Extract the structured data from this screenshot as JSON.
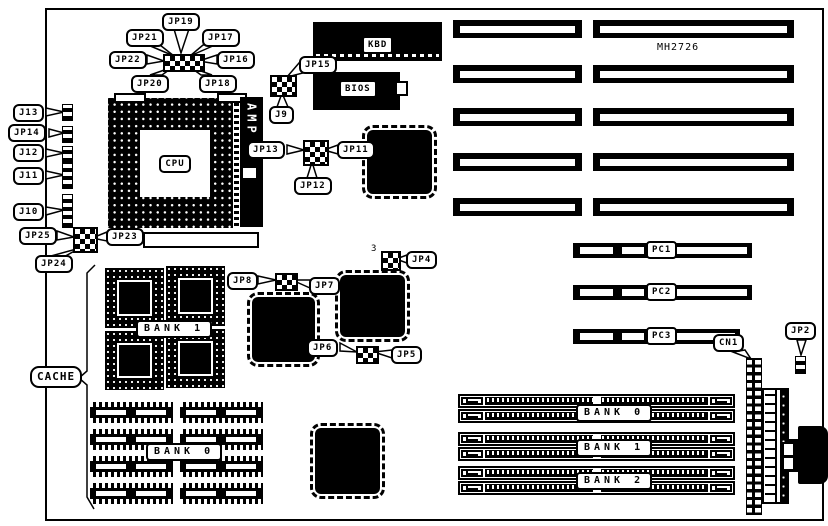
{
  "board": {
    "model": "MH2726"
  },
  "labels": {
    "jp19": "JP19",
    "jp21": "JP21",
    "jp17": "JP17",
    "jp22": "JP22",
    "jp16": "JP16",
    "jp20": "JP20",
    "jp18": "JP18",
    "jp15": "JP15",
    "j9": "J9",
    "kbd": "KBD",
    "bios": "BIOS",
    "j13": "J13",
    "jp14": "JP14",
    "j12": "J12",
    "j11": "J11",
    "j10": "J10",
    "jp25": "JP25",
    "jp23": "JP23",
    "jp24": "JP24",
    "cpu": "CPU",
    "amp": "AMP",
    "jp13": "JP13",
    "jp12": "JP12",
    "jp11": "JP11",
    "jp4": "JP4",
    "jp4_pin": "3",
    "jp8": "JP8",
    "jp7": "JP7",
    "jp6": "JP6",
    "jp5": "JP5",
    "cache": "CACHE",
    "cache_bank1": "BANK 1",
    "cache_bank0": "BANK 0",
    "pc1": "PC1",
    "pc2": "PC2",
    "pc3": "PC3",
    "cn1": "CN1",
    "jp2": "JP2",
    "simm_bank0": "BANK 0",
    "simm_bank1": "BANK 1",
    "simm_bank2": "BANK 2"
  },
  "colors": {
    "line": "#000000",
    "background": "#ffffff"
  }
}
